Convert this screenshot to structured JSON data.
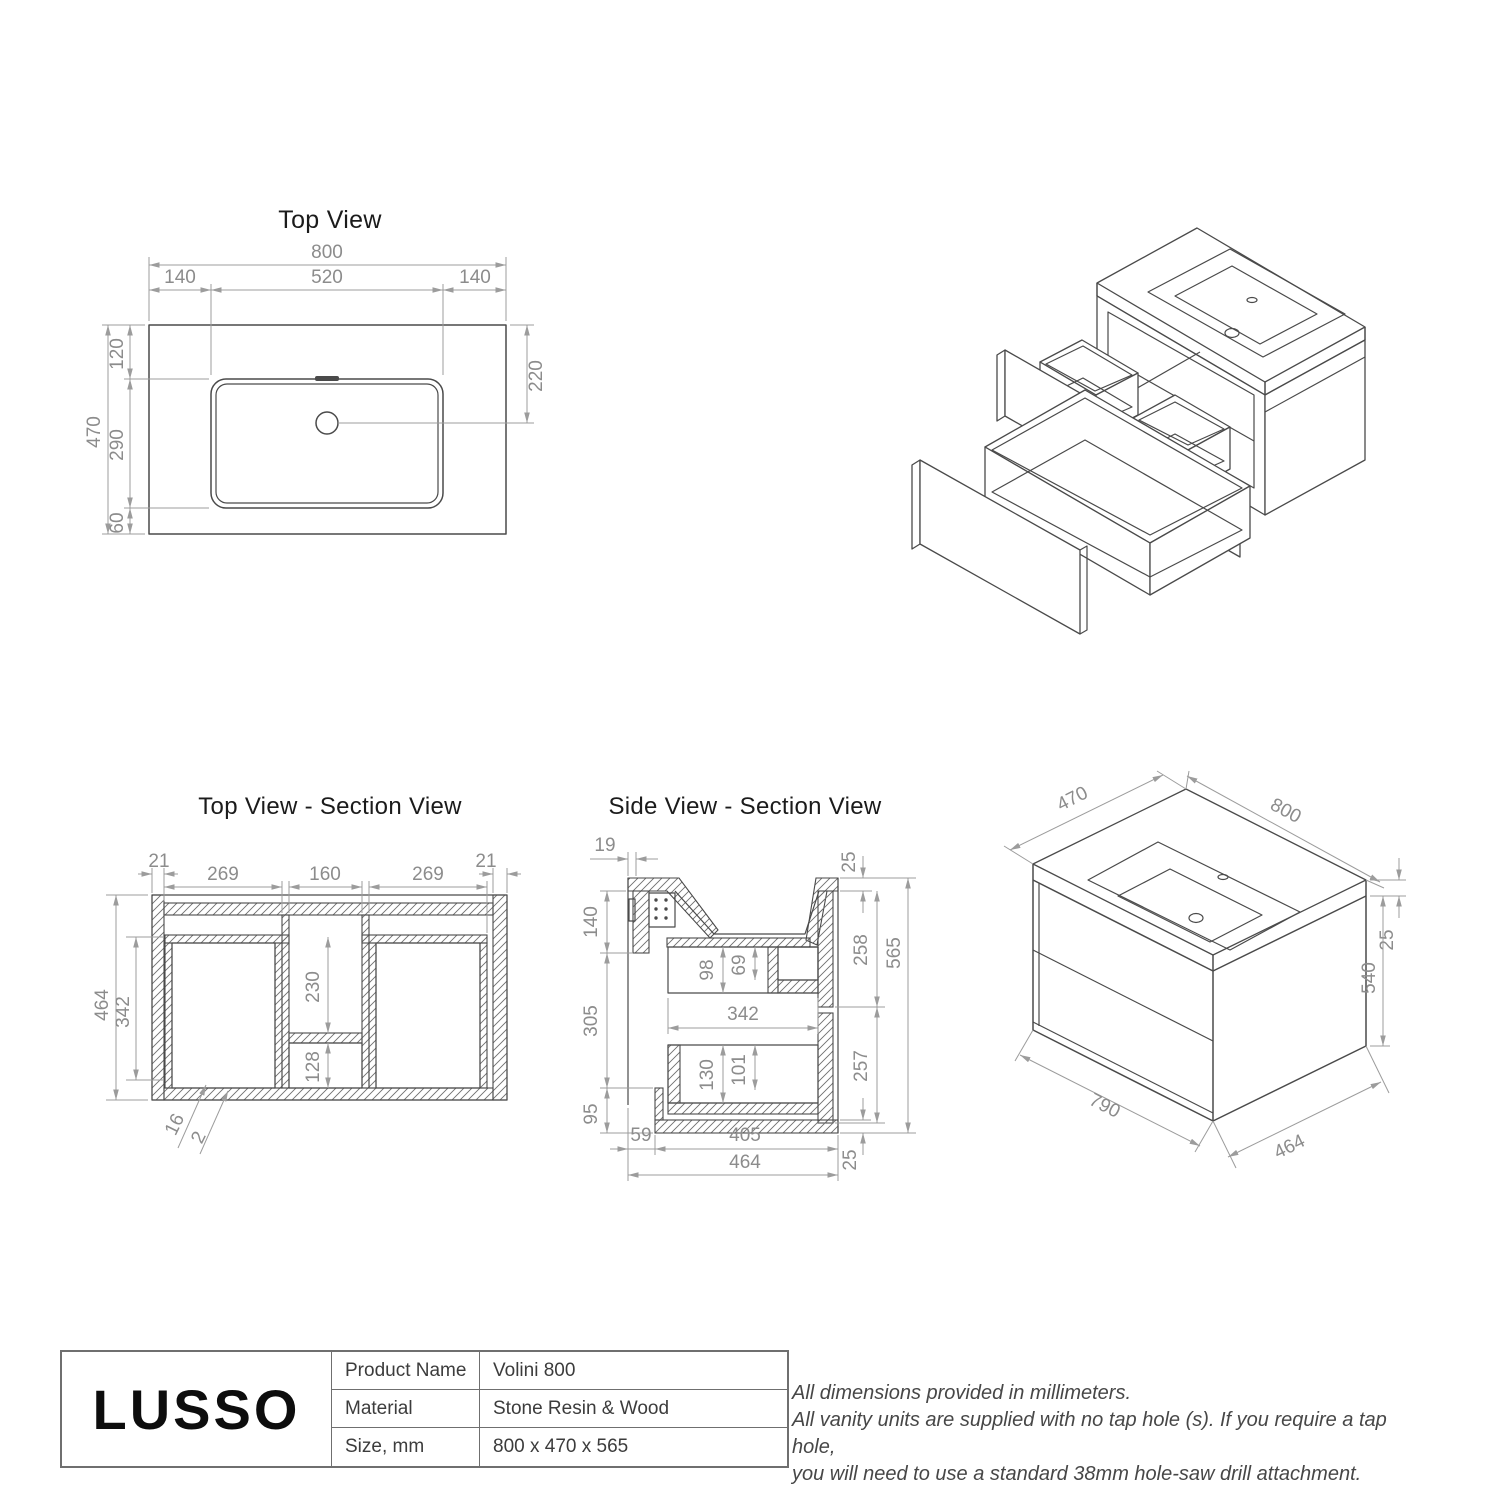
{
  "colors": {
    "background": "#ffffff",
    "object_line": "#4a4a4a",
    "dimension_gray": "#8c8c8c",
    "text_dark": "#1b1b1b"
  },
  "views": {
    "top": {
      "title": "Top View",
      "dim_w": "800",
      "dim_wl": "140",
      "dim_wc": "520",
      "dim_wr": "140",
      "dim_h": "470",
      "dim_h1": "120",
      "dim_h2": "290",
      "dim_h3": "60",
      "dim_drain": "220"
    },
    "top_section": {
      "title": "Top View - Section View",
      "dim_wall_l": "21",
      "dim_bay_l": "269",
      "dim_center": "160",
      "dim_bay_r": "269",
      "dim_wall_r": "21",
      "dim_h": "464",
      "dim_h_inner": "342",
      "dim_channel": "230",
      "dim_box": "128",
      "dim_t1": "16",
      "dim_t2": "2"
    },
    "side_section": {
      "title": "Side View - Section View",
      "dim_back": "19",
      "dim_top": "25",
      "dim_hang": "140",
      "dim_d1f": "98",
      "dim_d1b": "69",
      "dim_front1": "258",
      "dim_total_h": "565",
      "dim_mid": "305",
      "dim_inner_w": "342",
      "dim_d2f": "130",
      "dim_d2b": "101",
      "dim_front2": "257",
      "dim_bottom": "95",
      "dim_gap": "59",
      "dim_base_w": "405",
      "dim_depth": "464",
      "dim_base_t": "25"
    },
    "iso": {
      "dim_depth": "470",
      "dim_width": "800",
      "dim_slab": "25",
      "dim_height": "540",
      "dim_body_w": "790",
      "dim_body_d": "464"
    }
  },
  "title_block": {
    "logo": "LUSSO",
    "rows": [
      {
        "label": "Product Name",
        "value": "Volini 800"
      },
      {
        "label": "Material",
        "value": "Stone Resin & Wood"
      },
      {
        "label": "Size, mm",
        "value": "800 x 470 x 565"
      }
    ]
  },
  "notes": {
    "line1": "All dimensions provided in millimeters.",
    "line2": "All vanity units are supplied with no tap hole (s). If you require a tap hole,",
    "line3": "you will need to use a standard 38mm hole-saw drill attachment."
  }
}
